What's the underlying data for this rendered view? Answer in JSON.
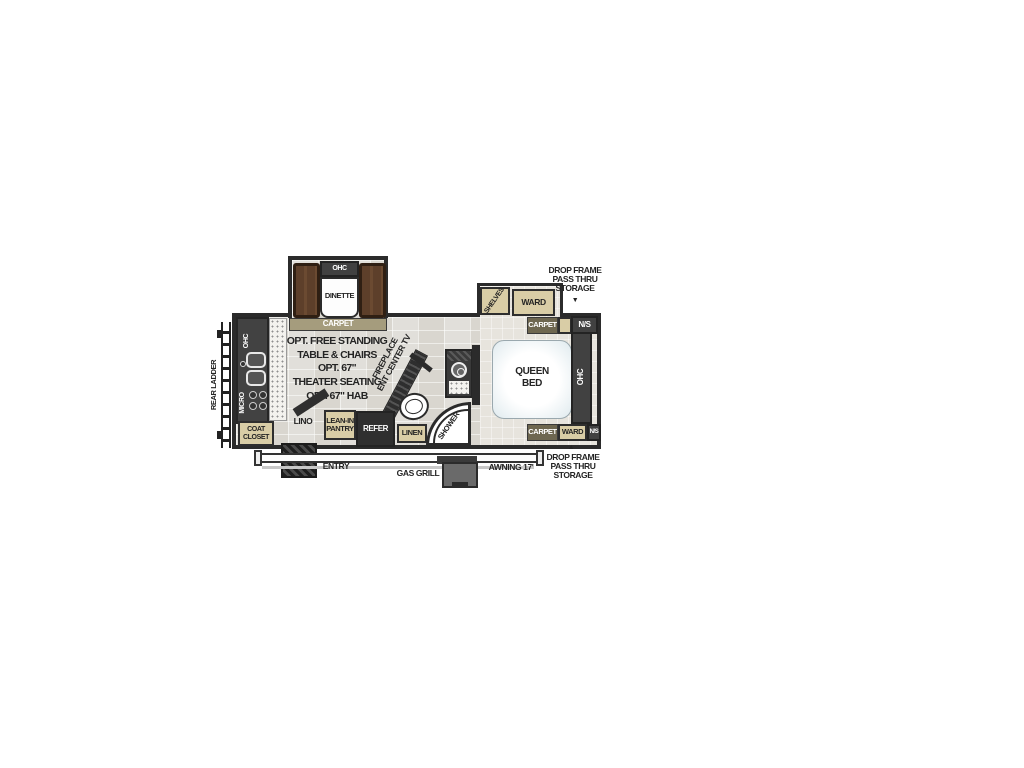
{
  "title": "Travel trailer floor plan",
  "colors": {
    "wall": "#2b2b2b",
    "tan": "#d9cda6",
    "olive": "#6e6750",
    "bench": "#5d3f2a",
    "bed": "#eef3f6"
  },
  "plan": {
    "exterior": {
      "rear_ladder": "REAR LADDER",
      "entry": "ENTRY",
      "gas_grill": "GAS GRILL",
      "awning": "AWNING 17'",
      "storage_top": [
        "DROP FRAME",
        "PASS THRU",
        "STORAGE"
      ],
      "storage_top_arrow": "▼",
      "storage_bottom": [
        "DROP FRAME",
        "PASS THRU",
        "STORAGE"
      ],
      "storage_bottom_arrow": "▲"
    },
    "dinette": {
      "ohc": "OHC",
      "label": "DINETTE",
      "carpet": "CARPET"
    },
    "kitchen": {
      "ohc": "OHC",
      "micro": "MICRO",
      "coat_closet": [
        "COAT",
        "CLOSET"
      ],
      "lino": "LINO"
    },
    "living": {
      "options": [
        "OPT. FREE STANDING",
        "TABLE & CHAIRS",
        "OPT. 67\"",
        "THEATER SEATING",
        "OPT. 67\" HAB"
      ],
      "fireplace": [
        "FIREPLACE",
        "ENT CENTER TV"
      ],
      "pantry": [
        "LEAN-IN",
        "PANTRY"
      ],
      "refer": "REFER"
    },
    "bath": {
      "linen": "LINEN",
      "shower": "SHOWER"
    },
    "bedroom": {
      "shelves": "SHELVES",
      "ward_top": "WARD",
      "carpet_top": "CARPET",
      "ns_top": "N/S",
      "bed": [
        "QUEEN",
        "BED"
      ],
      "ohc": "OHC",
      "carpet_bottom": "CARPET",
      "ward_bottom": "WARD",
      "ns_bottom": "N/S"
    }
  }
}
